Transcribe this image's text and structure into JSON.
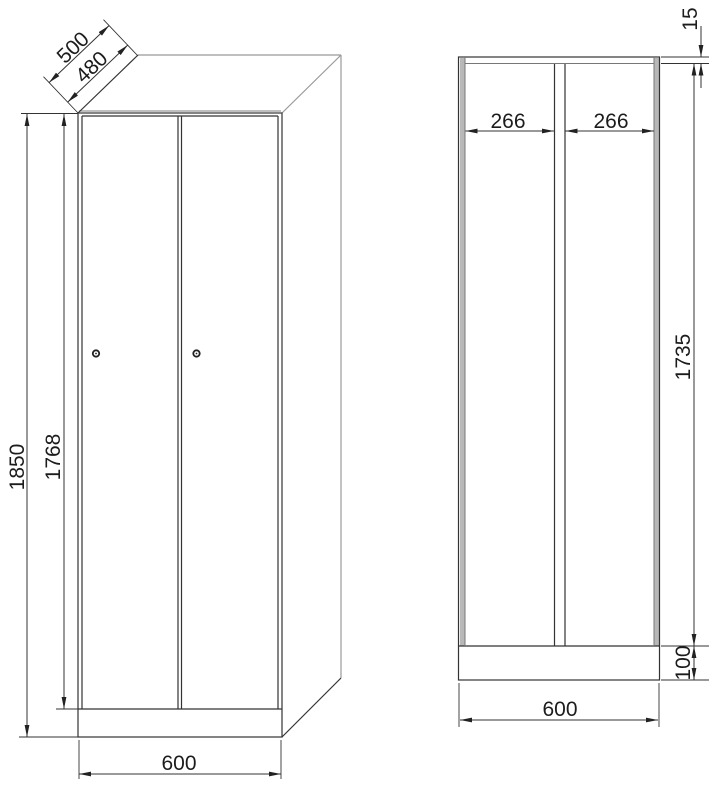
{
  "drawing": {
    "title": "locker-cabinet-dimension-drawing",
    "units": "mm",
    "colors": {
      "background": "#ffffff",
      "line_dark": "#333333",
      "line_gray": "#999999",
      "wall_inner_line": "#777777",
      "wall_fill": "#b8b8b8",
      "text": "#1c1c1c"
    },
    "front_view": {
      "dim_depth_outer": "500",
      "dim_depth_inner": "480",
      "dim_height_total": "1850",
      "dim_door_height": "1768",
      "dim_width": "600",
      "door_count": 2,
      "lock_count": 2
    },
    "section_view": {
      "dim_top_thickness": "15",
      "dim_compartment_left": "266",
      "dim_compartment_right": "266",
      "dim_interior_height": "1735",
      "dim_plinth_height": "100",
      "dim_width": "600"
    }
  }
}
